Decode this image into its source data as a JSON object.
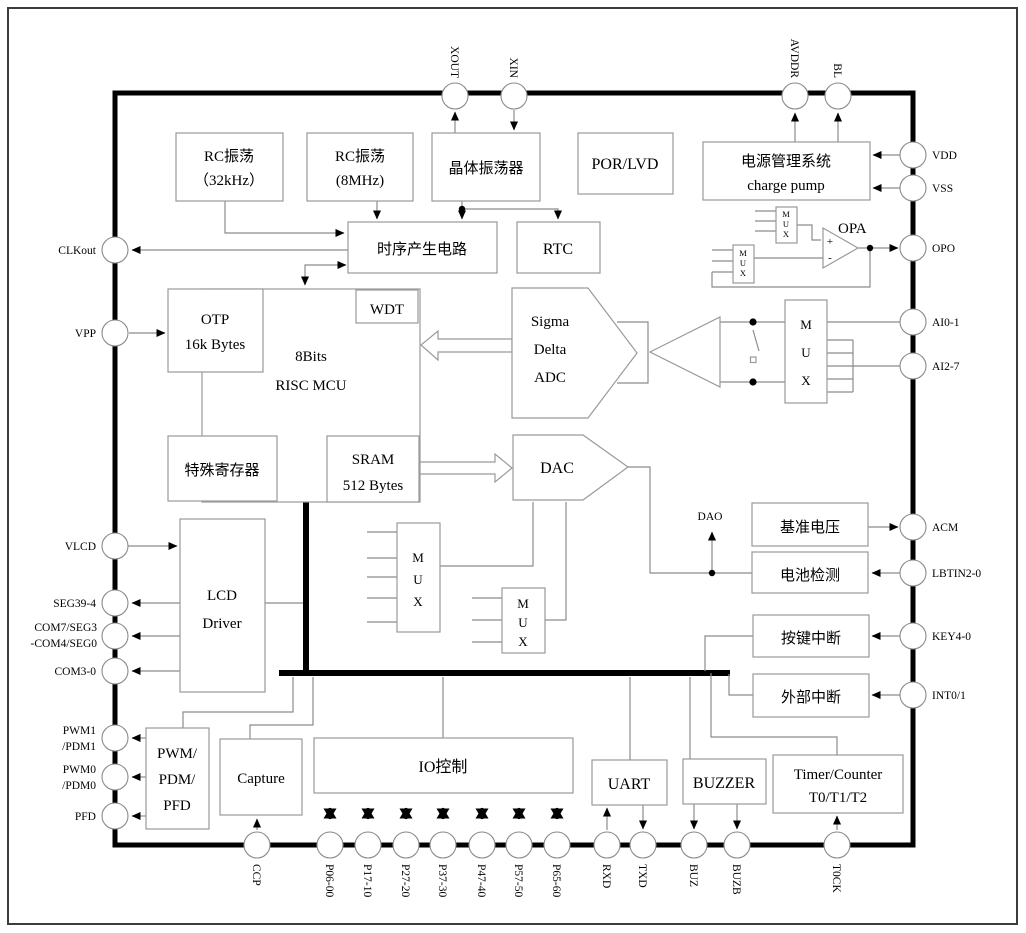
{
  "page": {
    "background": "#ffffff"
  },
  "colors": {
    "wire": "#8c8c8c",
    "block_border": "#9a9a9a",
    "ink": "#000000",
    "bus": "#000000",
    "chip_border": "#000000"
  },
  "blocks": {
    "rc_osc_32k": {
      "line1": "RC振荡",
      "line2": "（32kHz）"
    },
    "rc_osc_8mhz": {
      "line1": "RC振荡",
      "line2": "(8MHz)"
    },
    "crystal_osc": {
      "label": "晶体振荡器"
    },
    "por_lvd": {
      "label": "POR/LVD"
    },
    "power_mgmt": {
      "line1": "电源管理系统",
      "line2": "charge pump"
    },
    "timing_gen": {
      "label": "时序产生电路"
    },
    "rtc": {
      "label": "RTC"
    },
    "wdt": {
      "label": "WDT"
    },
    "otp": {
      "line1": "OTP",
      "line2": "16k Bytes"
    },
    "mcu": {
      "line1": "8Bits",
      "line2": "RISC  MCU"
    },
    "special_reg": {
      "label": "特殊寄存器"
    },
    "sram": {
      "line1": "SRAM",
      "line2": "512 Bytes"
    },
    "adc": {
      "line1": "Sigma",
      "line2": "Delta",
      "line3": "ADC"
    },
    "dac": {
      "label": "DAC"
    },
    "lcd_driver": {
      "line1": "LCD",
      "line2": "Driver"
    },
    "vref": {
      "label": "基准电压"
    },
    "battery_detect": {
      "label": "电池检测"
    },
    "key_interrupt": {
      "label": "按键中断"
    },
    "ext_interrupt": {
      "label": "外部中断"
    },
    "pwm": {
      "line1": "PWM/",
      "line2": "PDM/",
      "line3": "PFD"
    },
    "capture": {
      "label": "Capture"
    },
    "io_control": {
      "label": "IO控制"
    },
    "uart": {
      "label": "UART"
    },
    "buzzer": {
      "label": "BUZZER"
    },
    "timer": {
      "line1": "Timer/Counter",
      "line2": "T0/T1/T2"
    }
  },
  "labels": {
    "mux_m": "M",
    "mux_u": "U",
    "mux_x": "X",
    "opa": "OPA",
    "dao": "DAO",
    "plus": "+",
    "minus": "-"
  },
  "pins": {
    "top": [
      {
        "name": "XOUT"
      },
      {
        "name": "XIN"
      },
      {
        "name": "AVDDR"
      },
      {
        "name": "BL"
      }
    ],
    "left": [
      {
        "name": "CLKout"
      },
      {
        "name": "VPP"
      },
      {
        "name": "VLCD"
      },
      {
        "name": "SEG39-4"
      },
      {
        "name": "COM7/SEG3",
        "name2": "-COM4/SEG0"
      },
      {
        "name": "COM3-0"
      },
      {
        "name": "PWM1",
        "name2": "/PDM1"
      },
      {
        "name": "PWM0",
        "name2": "/PDM0"
      },
      {
        "name": "PFD"
      }
    ],
    "right": [
      {
        "name": "VDD"
      },
      {
        "name": "VSS"
      },
      {
        "name": "OPO"
      },
      {
        "name": "AI0-1"
      },
      {
        "name": "AI2-7"
      },
      {
        "name": "ACM"
      },
      {
        "name": "LBTIN2-0"
      },
      {
        "name": "KEY4-0"
      },
      {
        "name": "INT0/1"
      }
    ],
    "bottom": [
      {
        "name": "CCP"
      },
      {
        "name": "P06-00"
      },
      {
        "name": "P17-10"
      },
      {
        "name": "P27-20"
      },
      {
        "name": "P37-30"
      },
      {
        "name": "P47-40"
      },
      {
        "name": "P57-50"
      },
      {
        "name": "P65-60"
      },
      {
        "name": "RXD"
      },
      {
        "name": "TXD"
      },
      {
        "name": "BUZ"
      },
      {
        "name": "BUZB"
      },
      {
        "name": "T0CK"
      }
    ]
  }
}
